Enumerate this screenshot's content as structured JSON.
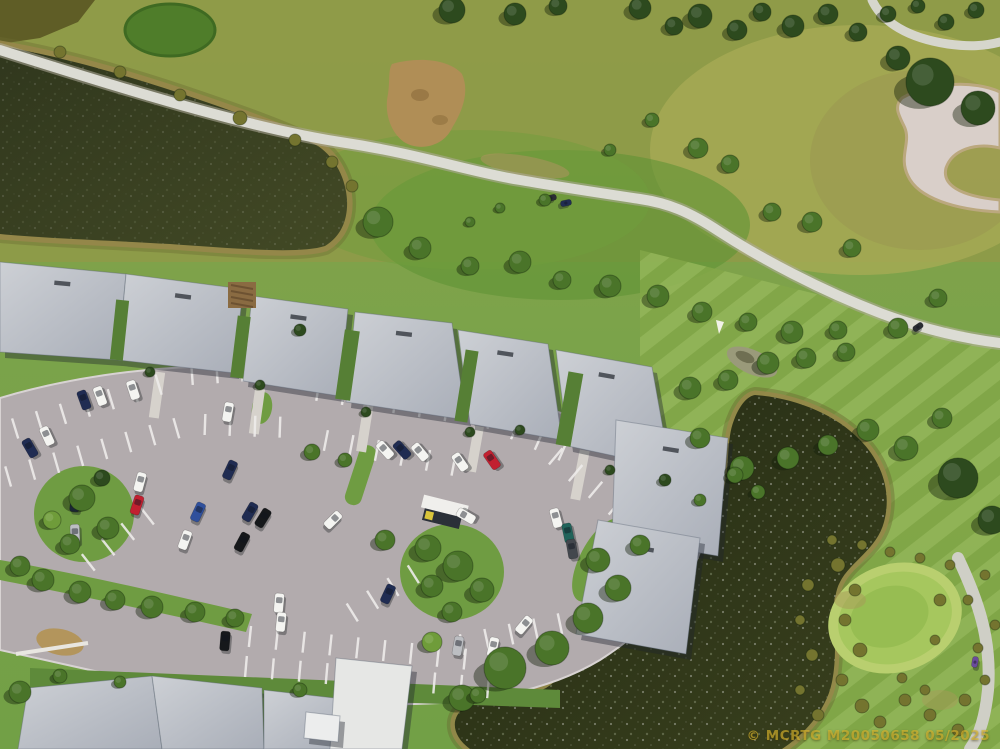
{
  "meta": {
    "description": "Aerial drone photo of a golf-course condominium community with two ponds, a winding cart path, a curved parking lot with cars, gray condo roofs, a sand bunker and a putting green"
  },
  "watermark": {
    "text": "© MCRTG M20050658 05/2025",
    "color": "#e0bc2e"
  },
  "palette": {
    "grass_base": "#7ca347",
    "grass_light": "#a3ab52",
    "grass_dark": "#5f9335",
    "rough_olive": "#8f9246",
    "water_dark": "#2b3219",
    "water_lake": "#363d20",
    "shore_tan": "#97874a",
    "path_gray": "#dcdcd4",
    "asphalt": "#b2abad",
    "roof_light": "#c9ccd1",
    "roof_dark": "#aeb3bc",
    "bunker_sand": "#d9cfc9",
    "tree_dark": "#2d4a1e",
    "tree_mid": "#4a7429",
    "tree_light": "#6f9c3a",
    "bush_olive": "#74742f",
    "car_colors": {
      "W": "#f4f4f1",
      "N": "#202c52",
      "K": "#16181b",
      "R": "#c22030",
      "S": "#bcbec2",
      "B": "#30509c",
      "T": "#20635a",
      "G": "#43474d",
      "P": "#6a4b9c",
      "D": "#2a2d33"
    }
  },
  "regions": [
    "lake-top-left",
    "right-pond",
    "golf-fairway",
    "cart-path",
    "sand-bunker",
    "putting-green",
    "condo-roofs",
    "parking-lot",
    "landscaped-islands",
    "palm-trees"
  ],
  "buildings": [
    {
      "p": [
        [
          0,
          262
        ],
        [
          126,
          274
        ],
        [
          118,
          360
        ],
        [
          0,
          352
        ]
      ],
      "v": 1
    },
    {
      "p": [
        [
          126,
          274
        ],
        [
          243,
          289
        ],
        [
          234,
          373
        ],
        [
          118,
          360
        ]
      ],
      "v": 1
    },
    {
      "p": [
        [
          252,
          296
        ],
        [
          348,
          309
        ],
        [
          339,
          396
        ],
        [
          243,
          381
        ]
      ],
      "v": 1
    },
    {
      "p": [
        [
          355,
          312
        ],
        [
          452,
          323
        ],
        [
          466,
          420
        ],
        [
          346,
          402
        ]
      ],
      "v": 1
    },
    {
      "p": [
        [
          458,
          330
        ],
        [
          548,
          344
        ],
        [
          562,
          440
        ],
        [
          470,
          424
        ]
      ],
      "v": 1
    },
    {
      "p": [
        [
          556,
          350
        ],
        [
          652,
          367
        ],
        [
          670,
          468
        ],
        [
          568,
          446
        ]
      ],
      "v": 1
    },
    {
      "p": [
        [
          616,
          420
        ],
        [
          728,
          438
        ],
        [
          718,
          556
        ],
        [
          612,
          538
        ]
      ],
      "v": 1
    },
    {
      "p": [
        [
          598,
          520
        ],
        [
          700,
          538
        ],
        [
          686,
          654
        ],
        [
          576,
          634
        ]
      ],
      "v": 1
    },
    {
      "p": [
        [
          28,
          688
        ],
        [
          152,
          676
        ],
        [
          162,
          749
        ],
        [
          18,
          749
        ]
      ]
    },
    {
      "p": [
        [
          152,
          676
        ],
        [
          262,
          688
        ],
        [
          264,
          749
        ],
        [
          162,
          749
        ]
      ]
    },
    {
      "p": [
        [
          264,
          690
        ],
        [
          352,
          700
        ],
        [
          348,
          749
        ],
        [
          264,
          749
        ]
      ]
    },
    {
      "p": [
        [
          336,
          658
        ],
        [
          412,
          666
        ],
        [
          402,
          749
        ],
        [
          330,
          749
        ]
      ],
      "f": "#e6e7e5"
    },
    {
      "p": [
        [
          306,
          712
        ],
        [
          340,
          716
        ],
        [
          338,
          742
        ],
        [
          304,
          738
        ]
      ],
      "f": "#eceded"
    }
  ],
  "stall_rows": [
    [
      15,
      428,
      -17,
      7,
      25
    ],
    [
      8,
      476,
      -16,
      8,
      25
    ],
    [
      192,
      374,
      -4,
      5,
      25
    ],
    [
      205,
      424,
      2,
      4,
      25
    ],
    [
      318,
      390,
      9,
      6,
      26
    ],
    [
      326,
      440,
      11,
      6,
      26
    ],
    [
      468,
      408,
      24,
      5,
      26
    ],
    [
      556,
      456,
      40,
      5,
      26
    ],
    [
      614,
      524,
      62,
      4,
      26
    ],
    [
      250,
      636,
      6,
      10,
      27
    ],
    [
      246,
      666,
      5,
      10,
      27
    ],
    [
      88,
      562,
      -38,
      4,
      25
    ],
    [
      352,
      612,
      -32,
      4,
      24
    ],
    [
      462,
      644,
      -12,
      5,
      25
    ]
  ],
  "cars": [
    [
      100,
      396,
      -20,
      "W",
      0
    ],
    [
      133,
      390,
      -18,
      "W",
      0
    ],
    [
      47,
      436,
      -25,
      "W",
      0
    ],
    [
      228,
      412,
      10,
      "W",
      0
    ],
    [
      140,
      482,
      15,
      "W",
      0
    ],
    [
      185,
      540,
      20,
      "W",
      0
    ],
    [
      279,
      603,
      5,
      "W",
      0
    ],
    [
      281,
      622,
      6,
      "W",
      0
    ],
    [
      333,
      520,
      45,
      "W",
      0
    ],
    [
      385,
      450,
      -42,
      "W",
      0
    ],
    [
      420,
      452,
      -40,
      "W",
      0
    ],
    [
      460,
      462,
      -35,
      "W",
      0
    ],
    [
      556,
      518,
      -15,
      "W",
      0
    ],
    [
      524,
      625,
      40,
      "W",
      0
    ],
    [
      493,
      647,
      12,
      "W",
      0
    ],
    [
      466,
      516,
      -60,
      "W",
      0
    ],
    [
      84,
      400,
      -20,
      "N",
      0
    ],
    [
      30,
      448,
      -30,
      "N",
      0
    ],
    [
      230,
      470,
      25,
      "N",
      0
    ],
    [
      250,
      512,
      30,
      "N",
      0
    ],
    [
      75,
      502,
      5,
      "N",
      0
    ],
    [
      402,
      450,
      -42,
      "N",
      0
    ],
    [
      388,
      594,
      25,
      "N",
      0
    ],
    [
      263,
      518,
      32,
      "K",
      0
    ],
    [
      242,
      542,
      28,
      "K",
      0
    ],
    [
      225,
      641,
      5,
      "K",
      0
    ],
    [
      137,
      505,
      18,
      "R",
      0
    ],
    [
      492,
      460,
      -35,
      "R",
      0
    ],
    [
      75,
      534,
      -2,
      "S",
      0
    ],
    [
      458,
      646,
      10,
      "S",
      0
    ],
    [
      198,
      512,
      25,
      "B",
      0
    ],
    [
      568,
      533,
      -12,
      "T",
      0
    ],
    [
      572,
      549,
      -10,
      "G",
      0
    ],
    [
      551,
      198,
      75,
      "D",
      1
    ],
    [
      566,
      203,
      78,
      "N",
      1
    ],
    [
      918,
      327,
      55,
      "D",
      1
    ],
    [
      975,
      662,
      10,
      "P",
      1
    ]
  ],
  "trees": [
    [
      700,
      16,
      12,
      0
    ],
    [
      737,
      30,
      10,
      0
    ],
    [
      762,
      12,
      9,
      0
    ],
    [
      793,
      26,
      11,
      0
    ],
    [
      828,
      14,
      10,
      0
    ],
    [
      858,
      32,
      9,
      0
    ],
    [
      888,
      14,
      8,
      0
    ],
    [
      918,
      6,
      7,
      0
    ],
    [
      946,
      22,
      8,
      0
    ],
    [
      976,
      10,
      8,
      0
    ],
    [
      452,
      10,
      13,
      0
    ],
    [
      515,
      14,
      11,
      0
    ],
    [
      558,
      6,
      9,
      0
    ],
    [
      640,
      8,
      11,
      0
    ],
    [
      674,
      26,
      9,
      0
    ],
    [
      930,
      82,
      24,
      0
    ],
    [
      978,
      108,
      17,
      0
    ],
    [
      898,
      58,
      12,
      0
    ],
    [
      378,
      222,
      15,
      1
    ],
    [
      420,
      248,
      11,
      1
    ],
    [
      470,
      266,
      9,
      1
    ],
    [
      520,
      262,
      11,
      1
    ],
    [
      562,
      280,
      9,
      1
    ],
    [
      610,
      286,
      11,
      1
    ],
    [
      658,
      296,
      11,
      1
    ],
    [
      702,
      312,
      10,
      1
    ],
    [
      748,
      322,
      9,
      1
    ],
    [
      792,
      332,
      11,
      1
    ],
    [
      838,
      330,
      9,
      1
    ],
    [
      690,
      388,
      11,
      1
    ],
    [
      728,
      380,
      10,
      1
    ],
    [
      768,
      363,
      11,
      1
    ],
    [
      806,
      358,
      10,
      1
    ],
    [
      846,
      352,
      9,
      1
    ],
    [
      700,
      438,
      10,
      1
    ],
    [
      742,
      468,
      12,
      1
    ],
    [
      788,
      458,
      11,
      1
    ],
    [
      828,
      445,
      10,
      1
    ],
    [
      868,
      430,
      11,
      1
    ],
    [
      906,
      448,
      12,
      1
    ],
    [
      942,
      418,
      10,
      1
    ],
    [
      898,
      328,
      10,
      1
    ],
    [
      938,
      298,
      9,
      1
    ],
    [
      852,
      248,
      9,
      1
    ],
    [
      812,
      222,
      10,
      1
    ],
    [
      772,
      212,
      9,
      1
    ],
    [
      698,
      148,
      10,
      1
    ],
    [
      730,
      164,
      9,
      1
    ],
    [
      958,
      478,
      20,
      0
    ],
    [
      992,
      520,
      14,
      0
    ],
    [
      505,
      668,
      21,
      1
    ],
    [
      552,
      648,
      17,
      1
    ],
    [
      588,
      618,
      15,
      1
    ],
    [
      618,
      588,
      13,
      1
    ],
    [
      462,
      698,
      13,
      1
    ],
    [
      432,
      642,
      10,
      2
    ],
    [
      598,
      560,
      12,
      1
    ],
    [
      640,
      545,
      10,
      1
    ],
    [
      428,
      548,
      13,
      1
    ],
    [
      458,
      566,
      15,
      1
    ],
    [
      482,
      590,
      12,
      1
    ],
    [
      432,
      586,
      11,
      1
    ],
    [
      452,
      612,
      10,
      1
    ],
    [
      385,
      540,
      10,
      1
    ],
    [
      82,
      498,
      13,
      1
    ],
    [
      108,
      528,
      11,
      1
    ],
    [
      70,
      544,
      10,
      1
    ],
    [
      102,
      478,
      8,
      0
    ],
    [
      52,
      520,
      9,
      2
    ],
    [
      43,
      580,
      11,
      1
    ],
    [
      80,
      592,
      11,
      1
    ],
    [
      115,
      600,
      10,
      1
    ],
    [
      152,
      607,
      11,
      1
    ],
    [
      195,
      612,
      10,
      1
    ],
    [
      235,
      618,
      9,
      1
    ],
    [
      20,
      566,
      10,
      1
    ],
    [
      60,
      676,
      7,
      1
    ],
    [
      120,
      682,
      6,
      1
    ],
    [
      300,
      690,
      7,
      1
    ],
    [
      478,
      695,
      8,
      1
    ],
    [
      20,
      692,
      11,
      1
    ],
    [
      150,
      372,
      5,
      0
    ],
    [
      260,
      385,
      5,
      0
    ],
    [
      300,
      330,
      6,
      0
    ],
    [
      366,
      412,
      5,
      0
    ],
    [
      470,
      432,
      5,
      0
    ],
    [
      520,
      430,
      5,
      0
    ],
    [
      610,
      470,
      5,
      0
    ],
    [
      665,
      480,
      6,
      0
    ],
    [
      700,
      500,
      6,
      1
    ],
    [
      735,
      475,
      8,
      1
    ],
    [
      758,
      492,
      7,
      1
    ],
    [
      312,
      452,
      8,
      1
    ],
    [
      345,
      460,
      7,
      1
    ],
    [
      838,
      565,
      7,
      3
    ],
    [
      855,
      590,
      6,
      3
    ],
    [
      845,
      620,
      6,
      3
    ],
    [
      860,
      650,
      7,
      3
    ],
    [
      842,
      680,
      6,
      3
    ],
    [
      862,
      706,
      7,
      3
    ],
    [
      880,
      722,
      6,
      3
    ],
    [
      905,
      700,
      6,
      3
    ],
    [
      930,
      715,
      6,
      3
    ],
    [
      958,
      730,
      6,
      3
    ],
    [
      902,
      678,
      5,
      3
    ],
    [
      925,
      690,
      5,
      3
    ],
    [
      965,
      700,
      6,
      3
    ],
    [
      985,
      680,
      5,
      3
    ],
    [
      978,
      648,
      5,
      3
    ],
    [
      995,
      625,
      5,
      3
    ],
    [
      968,
      600,
      5,
      3
    ],
    [
      985,
      575,
      5,
      3
    ],
    [
      950,
      565,
      5,
      3
    ],
    [
      920,
      558,
      5,
      3
    ],
    [
      890,
      552,
      5,
      3
    ],
    [
      862,
      545,
      5,
      3
    ],
    [
      832,
      540,
      5,
      3
    ],
    [
      808,
      585,
      6,
      3
    ],
    [
      800,
      620,
      5,
      3
    ],
    [
      812,
      655,
      6,
      3
    ],
    [
      800,
      690,
      5,
      3
    ],
    [
      818,
      715,
      6,
      3
    ],
    [
      940,
      600,
      6,
      3
    ],
    [
      935,
      640,
      5,
      3
    ],
    [
      60,
      52,
      6,
      3
    ],
    [
      120,
      72,
      6,
      3
    ],
    [
      180,
      95,
      6,
      3
    ],
    [
      240,
      118,
      7,
      3
    ],
    [
      295,
      140,
      6,
      3
    ],
    [
      332,
      162,
      6,
      3
    ],
    [
      352,
      186,
      6,
      3
    ],
    [
      545,
      200,
      6,
      1
    ],
    [
      500,
      208,
      5,
      1
    ],
    [
      470,
      222,
      5,
      1
    ],
    [
      652,
      120,
      7,
      1
    ],
    [
      610,
      150,
      6,
      1
    ]
  ]
}
